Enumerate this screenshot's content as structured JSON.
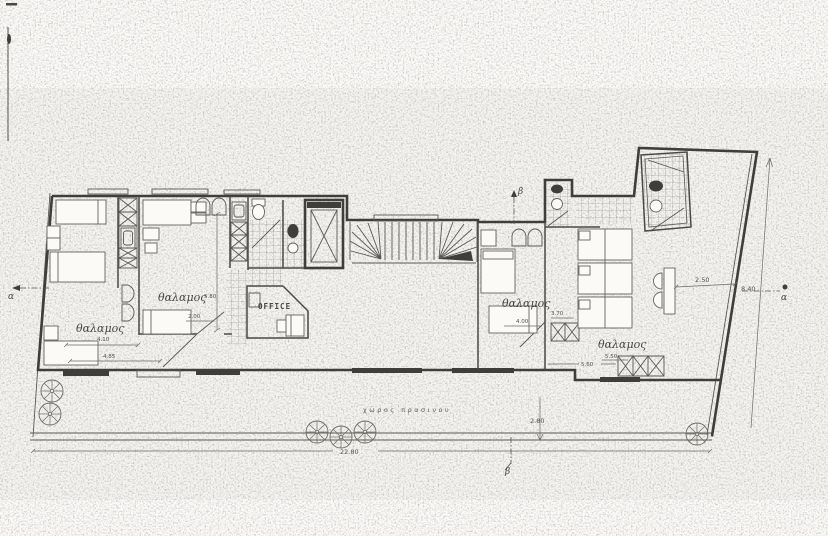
{
  "colors": {
    "paper": "#fbfaf7",
    "ink": "#3f3e3a",
    "furniture_line": "#64635c"
  },
  "labels": {
    "room_left": "θαλαμος",
    "room_center": "θαλαμος",
    "room_right": "θαλαμος",
    "room_wing": "θαλαμος",
    "office": "OFFICE",
    "green_space": "χωρος πρασινου"
  },
  "dimensions": {
    "room_left_width": "4.10",
    "room_left_total": "4.85",
    "room_center_depth": "5.80",
    "room_center_door": "2.00",
    "room_right_width": "4.00",
    "room_right_depth": "3.70",
    "room_wing_width": "5.50",
    "room_wing_line": "5.60",
    "terrace_width": "2.50",
    "side_length": "8.40",
    "green_depth": "2.80",
    "site_length": "22.80"
  },
  "section_markers": {
    "alpha_left": "α",
    "alpha_right": "α",
    "beta_top": "β",
    "beta_bottom": "β"
  }
}
